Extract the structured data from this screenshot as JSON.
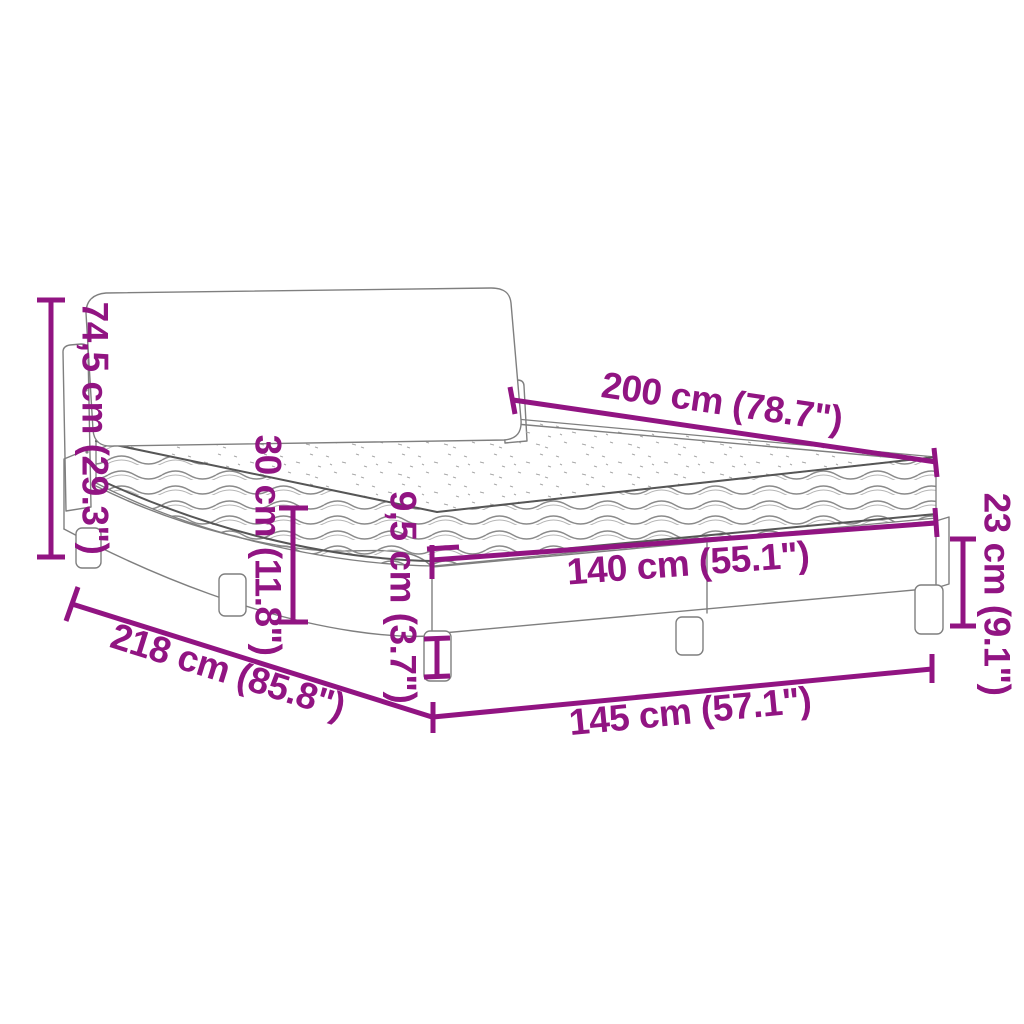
{
  "diagram": {
    "subject": "bed-with-mattress-dimension-diagram",
    "accent_color": "#911482",
    "art_line_color": "#7f7f7f",
    "background_color": "#ffffff"
  },
  "dims": {
    "total_height": {
      "cm": "74,5",
      "inch": "29.3",
      "label": "74,5 cm (29.3\")"
    },
    "length": {
      "cm": "200",
      "inch": "78.7",
      "label": "200 cm (78.7\")"
    },
    "mattress_thickness": {
      "cm": "30",
      "inch": "11.8",
      "label": "30 cm (11.8\")"
    },
    "leg_height": {
      "cm": "9,5",
      "inch": "3.7",
      "label": "9,5 cm (3.7\")"
    },
    "mattress_width": {
      "cm": "140",
      "inch": "55.1",
      "label": "140 cm (55.1\")"
    },
    "frame_height": {
      "cm": "23",
      "inch": "9.1",
      "label": "23 cm (9.1\")"
    },
    "total_depth": {
      "cm": "218",
      "inch": "85.8",
      "label": "218 cm (85.8\")"
    },
    "total_width": {
      "cm": "145",
      "inch": "57.1",
      "label": "145 cm (57.1\")"
    }
  }
}
